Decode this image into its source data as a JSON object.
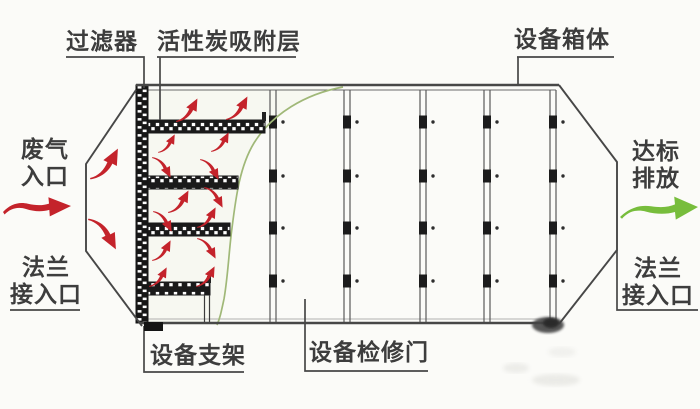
{
  "figure": {
    "callouts": {
      "filter": "过滤器",
      "carbon_layer": "活性炭吸附层",
      "equipment_box": "设备箱体",
      "waste_gas_inlet": [
        "废气",
        "入口"
      ],
      "flange_inlet": [
        "法兰",
        "接入口"
      ],
      "equipment_bracket": "设备支架",
      "maintenance_door": "设备检修门",
      "compliant_discharge": [
        "达标",
        "排放"
      ],
      "flange_outlet": [
        "法兰",
        "接入口"
      ]
    },
    "colors": {
      "line": "#474747",
      "text": "#3d3d3d",
      "red_arrow": "#c4232b",
      "green_arrow": "#77bd3c",
      "curve": "#a0b878",
      "background": "#fbfbf8"
    },
    "panel_seams": {
      "x_positions": [
        273,
        347,
        423,
        487,
        553
      ],
      "latch_y_positions": [
        122,
        176,
        228,
        281
      ]
    },
    "flow_arrows": [
      {
        "x": 90,
        "y": 148,
        "dir": "up",
        "s": 1.5
      },
      {
        "x": 88,
        "y": 220,
        "dir": "down",
        "s": 1.5
      },
      {
        "x": 176,
        "y": 98,
        "dir": "up",
        "s": 1.15
      },
      {
        "x": 226,
        "y": 96,
        "dir": "up",
        "s": 1.15
      },
      {
        "x": 158,
        "y": 134,
        "dir": "up",
        "s": 0.9
      },
      {
        "x": 211,
        "y": 132,
        "dir": "up",
        "s": 0.95
      },
      {
        "x": 152,
        "y": 158,
        "dir": "down",
        "s": 1.0
      },
      {
        "x": 200,
        "y": 160,
        "dir": "down",
        "s": 1.0
      },
      {
        "x": 168,
        "y": 190,
        "dir": "up",
        "s": 1.1
      },
      {
        "x": 204,
        "y": 188,
        "dir": "down",
        "s": 1.0
      },
      {
        "x": 153,
        "y": 212,
        "dir": "down",
        "s": 1.0
      },
      {
        "x": 197,
        "y": 207,
        "dir": "up",
        "s": 1.0
      },
      {
        "x": 152,
        "y": 240,
        "dir": "up",
        "s": 1.0
      },
      {
        "x": 197,
        "y": 239,
        "dir": "down",
        "s": 1.0
      },
      {
        "x": 149,
        "y": 267,
        "dir": "up",
        "s": 0.95
      },
      {
        "x": 196,
        "y": 266,
        "dir": "up",
        "s": 1.0
      }
    ]
  }
}
